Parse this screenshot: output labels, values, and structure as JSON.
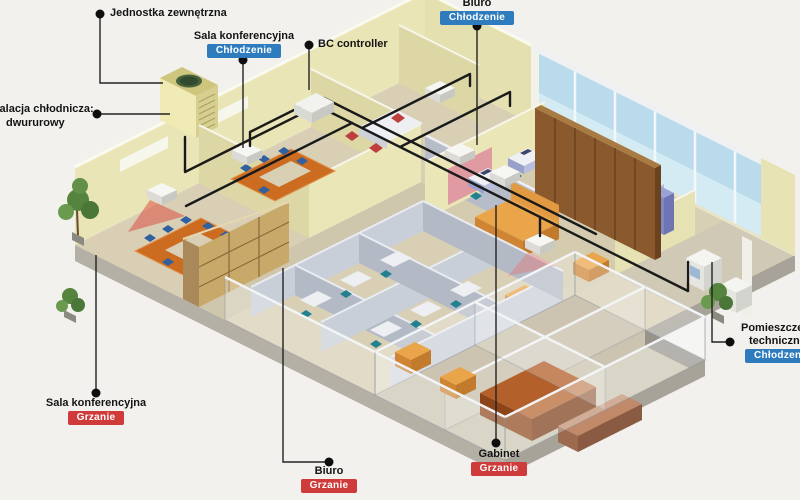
{
  "colors": {
    "cooling_badge": "#2e7cbe",
    "heating_badge": "#cf3a3a",
    "badge_text": "#ffffff",
    "label_text": "#141414",
    "background": "#f2f1ed",
    "pipe": "#1a1a1a",
    "wall": "#e9e5b6",
    "floor": "#d8cfb5",
    "glass": "#badbeb"
  },
  "callouts": {
    "outdoor_unit": {
      "text": "Jednostka zewnętrzna"
    },
    "conference_cooling": {
      "text": "Sala konferencyjna",
      "badge": "Chłodzenie"
    },
    "bc_controller": {
      "text": "BC controller"
    },
    "office_cooling": {
      "text": "Biuro",
      "badge": "Chłodzenie"
    },
    "piping": {
      "line1": "Instalacja chłodnicza:",
      "line2": "dwururowy"
    },
    "technical_room": {
      "line1": "Pomieszczenie",
      "line2": "techniczne",
      "badge": "Chłodzenie"
    },
    "conference_heating": {
      "text": "Sala konferencyjna",
      "badge": "Grzanie"
    },
    "office_heating": {
      "text": "Biuro",
      "badge": "Grzanie"
    },
    "cabinet_heating": {
      "text": "Gabinet",
      "badge": "Grzanie"
    }
  }
}
